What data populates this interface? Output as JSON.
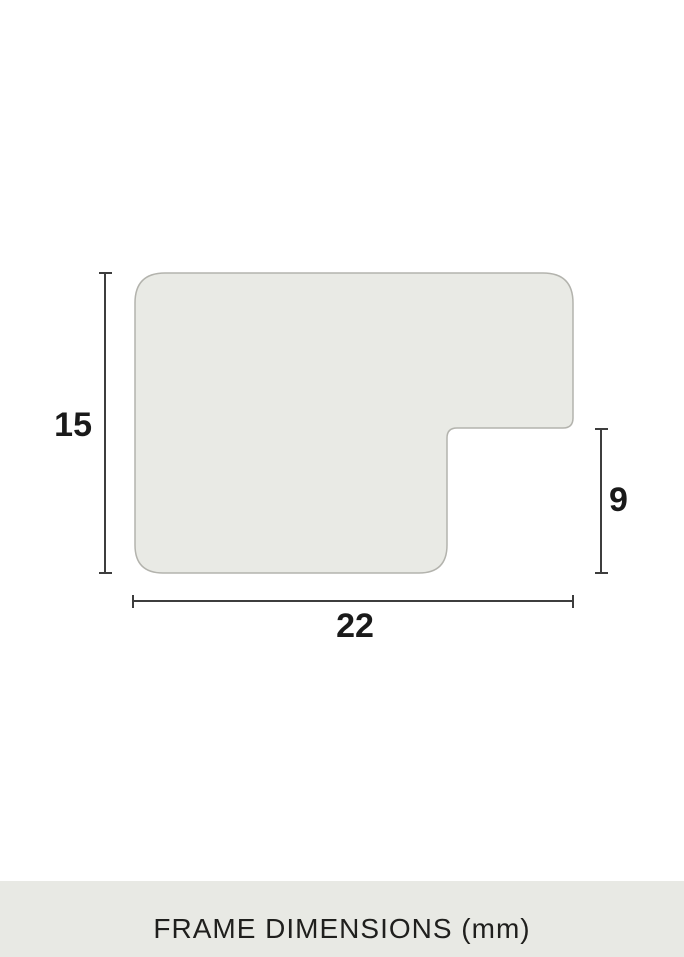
{
  "theme": {
    "background": "#ffffff",
    "shape_fill": "#e9eae5",
    "shape_stroke": "#b3b3ad",
    "dimension_line": "#3d3d3d",
    "label_text": "#1a1a1a",
    "footer_bg": "#e8e9e4",
    "footer_text": "#1f1f1d"
  },
  "diagram": {
    "kind": "frame-moulding-profile-cross-section",
    "dimensions": {
      "height_mm": "15",
      "depth_mm": "9",
      "width_mm": "22"
    }
  },
  "footer": {
    "label": "FRAME DIMENSIONS (mm)"
  }
}
